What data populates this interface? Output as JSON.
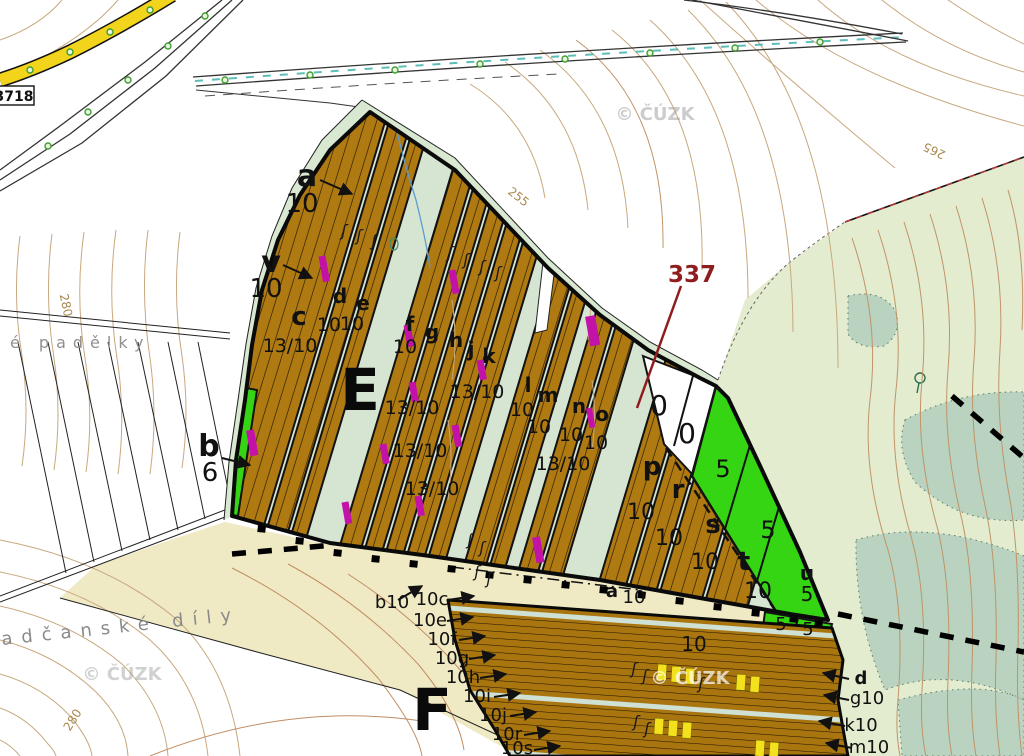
{
  "road_sign": {
    "label": "3718"
  },
  "sections": {
    "e": "E",
    "f": "F"
  },
  "parcel_337": "337",
  "watermark_text": "© ČÚZK",
  "colors": {
    "stand_brown": "#b07a12",
    "clearing_green": "#35d513",
    "interstrip": "#d6e5d2",
    "forest_pale": "#e3ecce",
    "forest_dark": "#b9d3c0",
    "field_beige": "#efe9c4",
    "road_yellow": "#f2d41c",
    "contour": "#c8a87e",
    "magenta": "#c312a8",
    "dashes_yellow": "#f2e11c",
    "red_label": "#8f1d1d",
    "watermark_gray": "#9a9a9a"
  },
  "texts": [
    {
      "t": "a",
      "x": 307,
      "y": 186,
      "s": 30,
      "w": "bold",
      "n": "stand-label-a"
    },
    {
      "t": "10",
      "x": 302,
      "y": 212,
      "s": 26,
      "n": "stand-value-a"
    },
    {
      "t": "v",
      "x": 271,
      "y": 272,
      "s": 30,
      "w": "bold",
      "n": "stand-label-v"
    },
    {
      "t": "10",
      "x": 266,
      "y": 297,
      "s": 26,
      "n": "stand-value-v"
    },
    {
      "t": "b",
      "x": 209,
      "y": 456,
      "s": 30,
      "w": "bold",
      "n": "stand-label-b"
    },
    {
      "t": "6",
      "x": 210,
      "y": 481,
      "s": 26,
      "n": "stand-value-b"
    },
    {
      "t": "c",
      "x": 299,
      "y": 325,
      "s": 26,
      "w": "bold",
      "n": "stand-label-c"
    },
    {
      "t": "13/10",
      "x": 290,
      "y": 352,
      "s": 19,
      "n": "stand-value"
    },
    {
      "t": "d",
      "x": 340,
      "y": 303,
      "s": 20,
      "w": "bold",
      "n": "stand-label-d"
    },
    {
      "t": "10",
      "x": 329,
      "y": 331,
      "s": 19,
      "n": "stand-value"
    },
    {
      "t": "e",
      "x": 363,
      "y": 310,
      "s": 20,
      "w": "bold",
      "n": "stand-label-e"
    },
    {
      "t": "10",
      "x": 352,
      "y": 330,
      "s": 19,
      "n": "stand-value"
    },
    {
      "t": "f",
      "x": 410,
      "y": 331,
      "s": 20,
      "w": "bold",
      "n": "stand-label-f"
    },
    {
      "t": "10",
      "x": 405,
      "y": 353,
      "s": 19,
      "n": "stand-value"
    },
    {
      "t": "g",
      "x": 432,
      "y": 339,
      "s": 20,
      "w": "bold",
      "n": "stand-label-g"
    },
    {
      "t": "h",
      "x": 456,
      "y": 347,
      "s": 20,
      "w": "bold",
      "n": "stand-label-h"
    },
    {
      "t": "j",
      "x": 471,
      "y": 356,
      "s": 20,
      "w": "bold",
      "n": "stand-label-j"
    },
    {
      "t": "k",
      "x": 489,
      "y": 363,
      "s": 20,
      "w": "bold",
      "n": "stand-label-k"
    },
    {
      "t": "13/10",
      "x": 477,
      "y": 398,
      "s": 19,
      "n": "stand-value"
    },
    {
      "t": "13/10",
      "x": 412,
      "y": 414,
      "s": 19,
      "n": "stand-value"
    },
    {
      "t": "13/10",
      "x": 420,
      "y": 457,
      "s": 19,
      "n": "stand-value"
    },
    {
      "t": "13/10",
      "x": 432,
      "y": 495,
      "s": 19,
      "n": "stand-value"
    },
    {
      "t": "l",
      "x": 528,
      "y": 392,
      "s": 20,
      "w": "bold",
      "n": "stand-label-l"
    },
    {
      "t": "10",
      "x": 522,
      "y": 416,
      "s": 19,
      "n": "stand-value"
    },
    {
      "t": "m",
      "x": 548,
      "y": 402,
      "s": 20,
      "w": "bold",
      "n": "stand-label-m"
    },
    {
      "t": "10",
      "x": 539,
      "y": 433,
      "s": 19,
      "n": "stand-value"
    },
    {
      "t": "n",
      "x": 579,
      "y": 413,
      "s": 20,
      "w": "bold",
      "n": "stand-label-n"
    },
    {
      "t": "10",
      "x": 571,
      "y": 441,
      "s": 19,
      "n": "stand-value"
    },
    {
      "t": "o",
      "x": 602,
      "y": 421,
      "s": 20,
      "w": "bold",
      "n": "stand-label-o"
    },
    {
      "t": "10",
      "x": 596,
      "y": 449,
      "s": 19,
      "n": "stand-value"
    },
    {
      "t": "13/10",
      "x": 563,
      "y": 470,
      "s": 19,
      "n": "stand-value"
    },
    {
      "t": "0",
      "x": 659,
      "y": 415,
      "s": 28,
      "n": "clearing-value-0"
    },
    {
      "t": "0",
      "x": 687,
      "y": 443,
      "s": 28,
      "n": "clearing-value-0"
    },
    {
      "t": "p",
      "x": 652,
      "y": 475,
      "s": 26,
      "w": "bold",
      "n": "stand-label-p"
    },
    {
      "t": "10",
      "x": 641,
      "y": 519,
      "s": 22,
      "n": "stand-value"
    },
    {
      "t": "r",
      "x": 678,
      "y": 498,
      "s": 26,
      "w": "bold",
      "n": "stand-label-r"
    },
    {
      "t": "10",
      "x": 669,
      "y": 545,
      "s": 22,
      "n": "stand-value"
    },
    {
      "t": "s",
      "x": 713,
      "y": 533,
      "s": 26,
      "w": "bold",
      "n": "stand-label-s"
    },
    {
      "t": "10",
      "x": 705,
      "y": 569,
      "s": 22,
      "n": "stand-value"
    },
    {
      "t": "t",
      "x": 744,
      "y": 570,
      "s": 26,
      "w": "bold",
      "n": "stand-label-t"
    },
    {
      "t": "10",
      "x": 758,
      "y": 598,
      "s": 22,
      "n": "stand-value"
    },
    {
      "t": "5",
      "x": 723,
      "y": 477,
      "s": 24,
      "n": "clearing-value-5"
    },
    {
      "t": "5",
      "x": 768,
      "y": 538,
      "s": 24,
      "n": "clearing-value-5"
    },
    {
      "t": "u",
      "x": 807,
      "y": 580,
      "s": 20,
      "w": "bold",
      "n": "stand-label-u"
    },
    {
      "t": "5",
      "x": 807,
      "y": 601,
      "s": 20,
      "n": "clearing-value-5"
    },
    {
      "t": "5",
      "x": 781,
      "y": 630,
      "s": 18,
      "n": "clearing-value-5"
    },
    {
      "t": "5",
      "x": 808,
      "y": 635,
      "s": 18,
      "n": "clearing-value-5"
    },
    {
      "t": "a",
      "x": 612,
      "y": 597,
      "s": 18,
      "w": "bold",
      "n": "stand-label-a2"
    },
    {
      "t": "10",
      "x": 634,
      "y": 603,
      "s": 18,
      "n": "stand-value"
    },
    {
      "t": "10",
      "x": 694,
      "y": 651,
      "s": 20,
      "n": "stand-value"
    },
    {
      "t": "b10",
      "x": 392,
      "y": 608,
      "s": 18,
      "n": "stand-label-b10"
    },
    {
      "t": "10c",
      "x": 432,
      "y": 605,
      "s": 18,
      "n": "stand-label-10c"
    },
    {
      "t": "10e",
      "x": 430,
      "y": 626,
      "s": 18,
      "n": "stand-label-10e"
    },
    {
      "t": "10f",
      "x": 442,
      "y": 645,
      "s": 18,
      "n": "stand-label-10f"
    },
    {
      "t": "10g",
      "x": 452,
      "y": 664,
      "s": 18,
      "n": "stand-label-10g"
    },
    {
      "t": "10h",
      "x": 463,
      "y": 683,
      "s": 18,
      "n": "stand-label-10h"
    },
    {
      "t": "10i",
      "x": 477,
      "y": 702,
      "s": 18,
      "n": "stand-label-10i"
    },
    {
      "t": "10j",
      "x": 493,
      "y": 721,
      "s": 18,
      "n": "stand-label-10j"
    },
    {
      "t": "10r",
      "x": 507,
      "y": 740,
      "s": 18,
      "n": "stand-label-10r"
    },
    {
      "t": "10s",
      "x": 517,
      "y": 754,
      "s": 18,
      "n": "stand-label-10s"
    },
    {
      "t": "d",
      "x": 861,
      "y": 684,
      "s": 18,
      "w": "bold",
      "n": "stand-label-d2"
    },
    {
      "t": "g10",
      "x": 867,
      "y": 704,
      "s": 18,
      "n": "stand-label-g10"
    },
    {
      "t": "k10",
      "x": 861,
      "y": 731,
      "s": 18,
      "n": "stand-label-k10"
    },
    {
      "t": "m10",
      "x": 869,
      "y": 753,
      "s": 18,
      "n": "stand-label-m10"
    },
    {
      "t": "é padělky",
      "x": 10,
      "y": 348,
      "s": 16,
      "c": "#8f8f8f",
      "ls": 7,
      "a": "start",
      "n": "place-name-padelky"
    },
    {
      "t": "adčanské díly",
      "x": 2,
      "y": 645,
      "s": 18,
      "c": "#8a8a8a",
      "ls": 9,
      "a": "start",
      "rot": -6,
      "n": "place-name-adcanske-dily"
    },
    {
      "t": "255",
      "x": 516,
      "y": 200,
      "s": 12,
      "c": "#a9884f",
      "rot": 38,
      "n": "contour-label-255"
    },
    {
      "t": "265",
      "x": 936,
      "y": 147,
      "s": 12,
      "c": "#a9884f",
      "rot": 205,
      "n": "contour-label-265"
    },
    {
      "t": "280",
      "x": 62,
      "y": 306,
      "s": 12,
      "c": "#a9884f",
      "rot": 78,
      "n": "contour-label-280"
    },
    {
      "t": "280",
      "x": 76,
      "y": 722,
      "s": 12,
      "c": "#a9884f",
      "rot": -58,
      "n": "contour-label-280"
    },
    {
      "t": "© ČÚZK",
      "x": 655,
      "y": 120,
      "s": 18,
      "w": "bold",
      "c": "#9a9a9a",
      "o": 0.5,
      "n": "watermark"
    },
    {
      "t": "© ČÚZK",
      "x": 122,
      "y": 680,
      "s": 18,
      "w": "bold",
      "c": "#9a9a9a",
      "o": 0.45,
      "n": "watermark"
    },
    {
      "t": "© ČÚZK",
      "x": 690,
      "y": 684,
      "s": 18,
      "w": "bold",
      "c": "#ffffff",
      "o": 0.7,
      "n": "watermark"
    }
  ],
  "leaders": [
    {
      "x1": 320,
      "y1": 180,
      "x2": 352,
      "y2": 194
    },
    {
      "x1": 283,
      "y1": 265,
      "x2": 312,
      "y2": 278
    },
    {
      "x1": 222,
      "y1": 458,
      "x2": 250,
      "y2": 465
    },
    {
      "x1": 398,
      "y1": 600,
      "x2": 422,
      "y2": 586
    },
    {
      "x1": 448,
      "y1": 600,
      "x2": 474,
      "y2": 596
    },
    {
      "x1": 447,
      "y1": 621,
      "x2": 473,
      "y2": 617
    },
    {
      "x1": 459,
      "y1": 640,
      "x2": 485,
      "y2": 636
    },
    {
      "x1": 469,
      "y1": 659,
      "x2": 495,
      "y2": 655
    },
    {
      "x1": 480,
      "y1": 678,
      "x2": 506,
      "y2": 674
    },
    {
      "x1": 494,
      "y1": 697,
      "x2": 520,
      "y2": 693
    },
    {
      "x1": 510,
      "y1": 716,
      "x2": 536,
      "y2": 712
    },
    {
      "x1": 524,
      "y1": 735,
      "x2": 550,
      "y2": 731
    },
    {
      "x1": 534,
      "y1": 750,
      "x2": 560,
      "y2": 746
    },
    {
      "x1": 849,
      "y1": 679,
      "x2": 823,
      "y2": 673
    },
    {
      "x1": 849,
      "y1": 700,
      "x2": 824,
      "y2": 695
    },
    {
      "x1": 845,
      "y1": 726,
      "x2": 819,
      "y2": 721
    },
    {
      "x1": 852,
      "y1": 748,
      "x2": 826,
      "y2": 743
    }
  ],
  "symbols": {
    "magenta_bars": [
      [
        322,
        256,
        7,
        26
      ],
      [
        452,
        270,
        7,
        24
      ],
      [
        250,
        430,
        8,
        26
      ],
      [
        407,
        325,
        7,
        22
      ],
      [
        480,
        360,
        7,
        20
      ],
      [
        412,
        382,
        7,
        20
      ],
      [
        455,
        425,
        7,
        22
      ],
      [
        383,
        444,
        7,
        20
      ],
      [
        418,
        496,
        7,
        20
      ],
      [
        345,
        502,
        7,
        22
      ],
      [
        536,
        537,
        8,
        26
      ],
      [
        590,
        316,
        10,
        30
      ],
      [
        589,
        408,
        6,
        20
      ]
    ],
    "yellow_bars": [
      [
        658,
        664
      ],
      [
        672,
        666
      ],
      [
        686,
        668
      ],
      [
        737,
        674
      ],
      [
        751,
        676
      ],
      [
        655,
        718
      ],
      [
        669,
        720
      ],
      [
        683,
        722
      ],
      [
        756,
        740
      ],
      [
        770,
        742
      ]
    ],
    "stand_marks": [
      [
        344,
        236
      ],
      [
        359,
        241
      ],
      [
        374,
        246
      ],
      [
        450,
        258
      ],
      [
        466,
        265
      ],
      [
        482,
        272
      ],
      [
        498,
        278
      ],
      [
        470,
        545
      ],
      [
        482,
        553
      ],
      [
        477,
        577
      ],
      [
        489,
        584
      ],
      [
        634,
        674
      ],
      [
        645,
        681
      ],
      [
        636,
        727
      ],
      [
        647,
        734
      ],
      [
        701,
        689
      ]
    ],
    "boundary_teeth": [
      [
        258,
        525
      ],
      [
        296,
        537
      ],
      [
        334,
        549
      ],
      [
        372,
        555
      ],
      [
        410,
        560
      ],
      [
        448,
        565
      ],
      [
        486,
        571
      ],
      [
        524,
        576
      ],
      [
        562,
        581
      ],
      [
        600,
        586
      ],
      [
        638,
        591
      ],
      [
        676,
        597
      ],
      [
        714,
        603
      ],
      [
        752,
        609
      ],
      [
        790,
        615
      ],
      [
        815,
        620
      ]
    ]
  }
}
